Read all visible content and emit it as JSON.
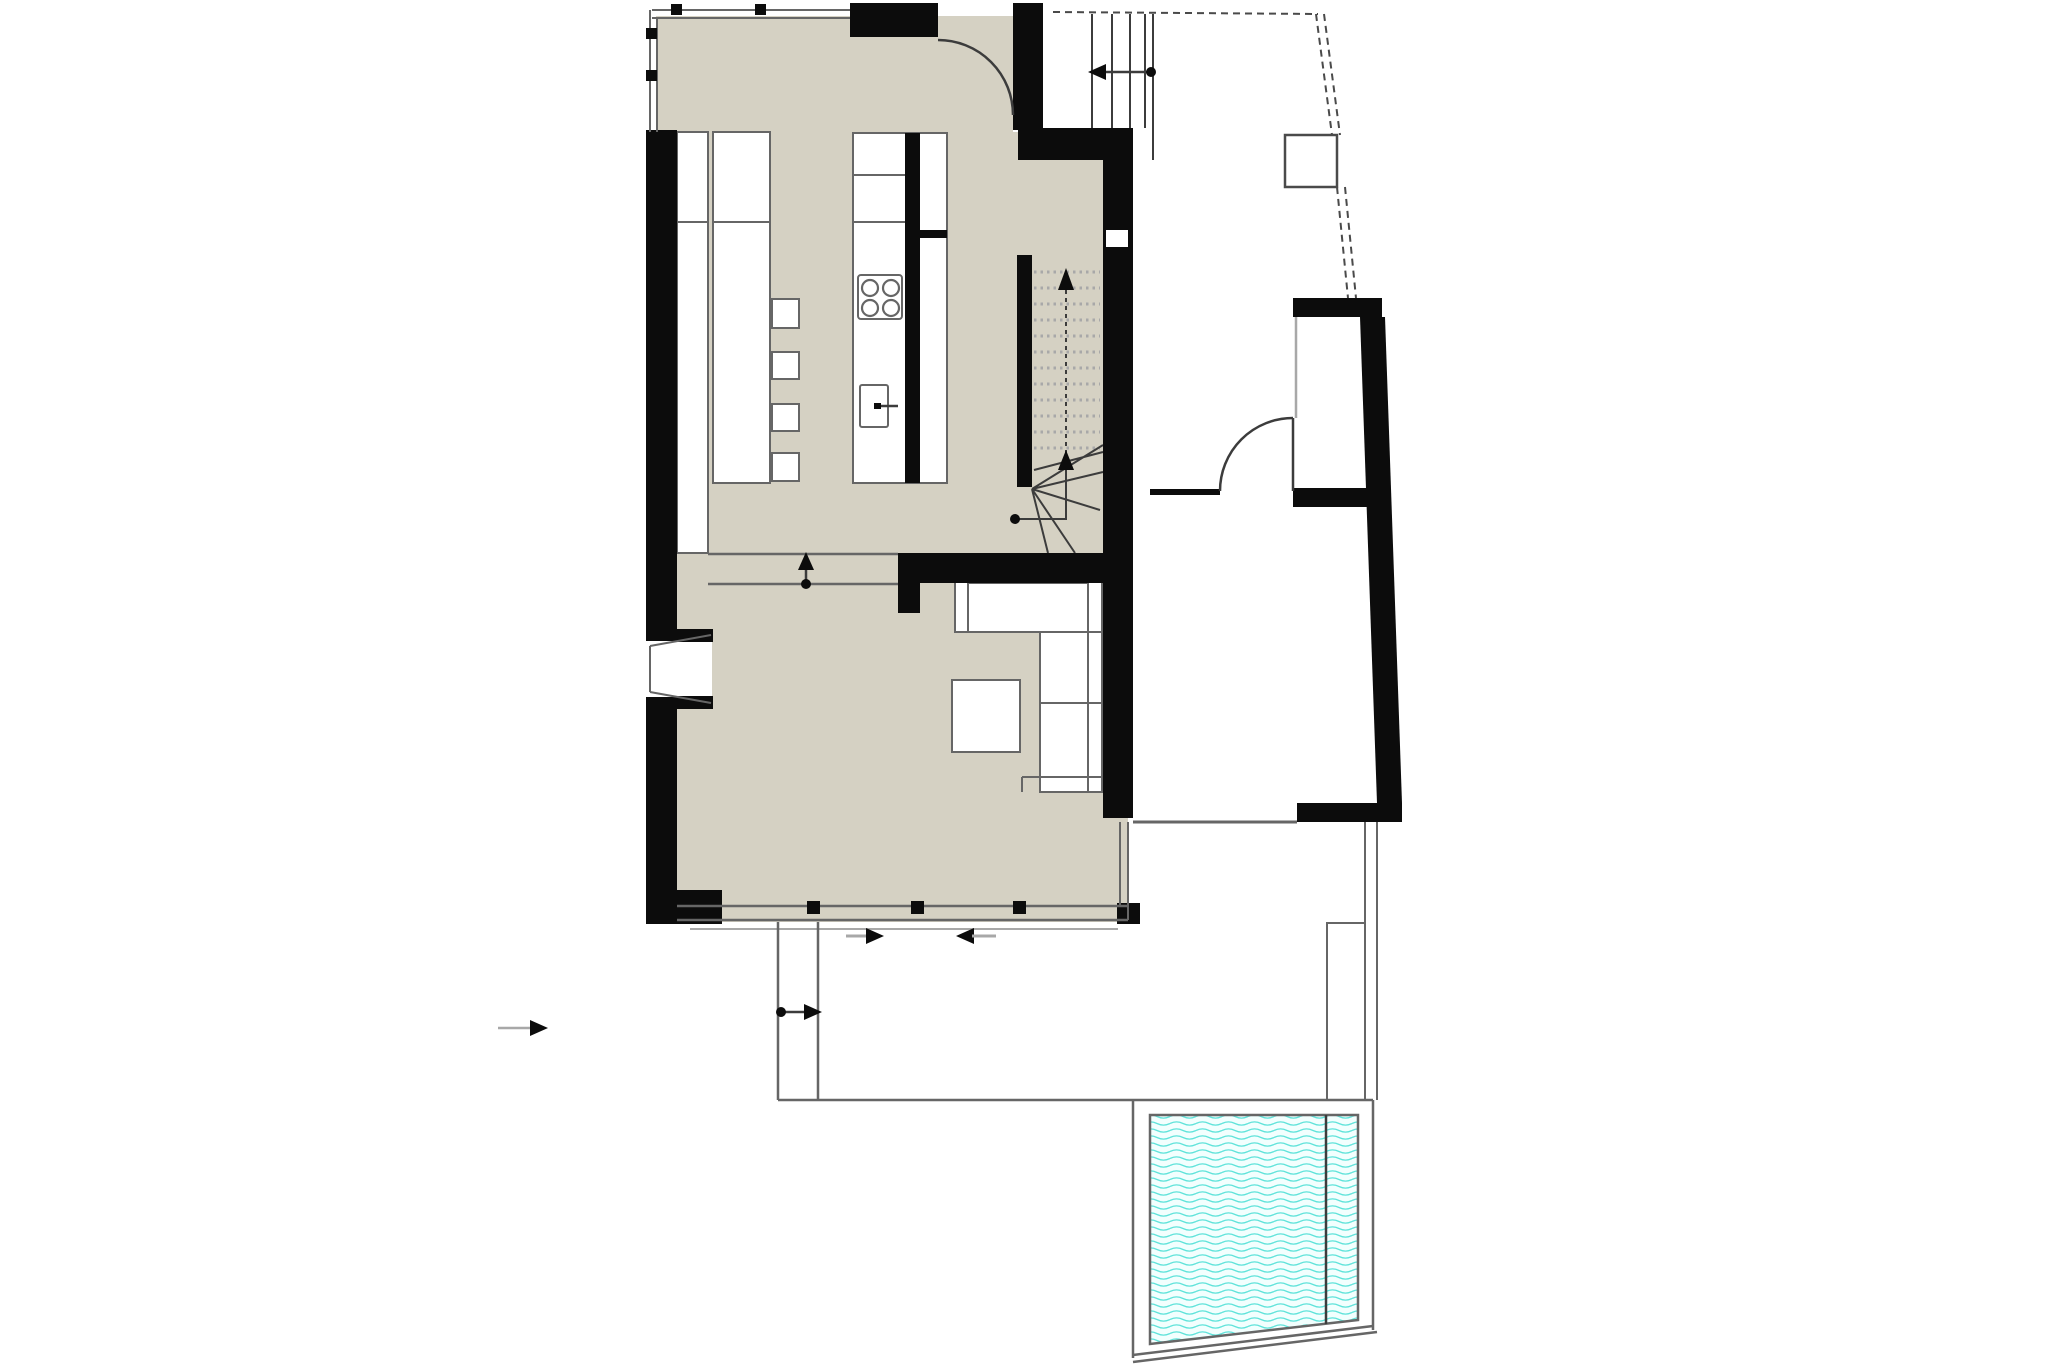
{
  "title": "architectural-floor-plan-ground-floor",
  "colors": {
    "wall": "#0c0c0c",
    "line": "#666666",
    "line-dark": "#3c3c3c",
    "line-light": "#a8a8a8",
    "floor": "#d5d1c3",
    "dash": "#4a4a4a",
    "arrow": "#0c0c0c",
    "water-line": "#5fe3da",
    "water-bg": "#f2fffe"
  },
  "plan": {
    "rooms": [
      "kitchen-dining-area",
      "living-room",
      "staircase",
      "entry-hall",
      "annex-room-upper",
      "annex-room-lower",
      "terrace",
      "pool"
    ],
    "furniture": [
      "wall-counter-tall",
      "wall-counter-low",
      "bar-stool",
      "bar-stool",
      "bar-stool",
      "bar-stool",
      "kitchen-island",
      "cooktop-symbol",
      "sink-symbol",
      "corner-sofa",
      "coffee-table"
    ],
    "symbols": [
      "door-swing-arc",
      "stair-up-arrow",
      "sliding-door-arrows",
      "entry-direction-arrow",
      "walkway-direction-arrow",
      "property-boundary-dashed-line",
      "utility-box",
      "water-hatch-pattern"
    ]
  }
}
